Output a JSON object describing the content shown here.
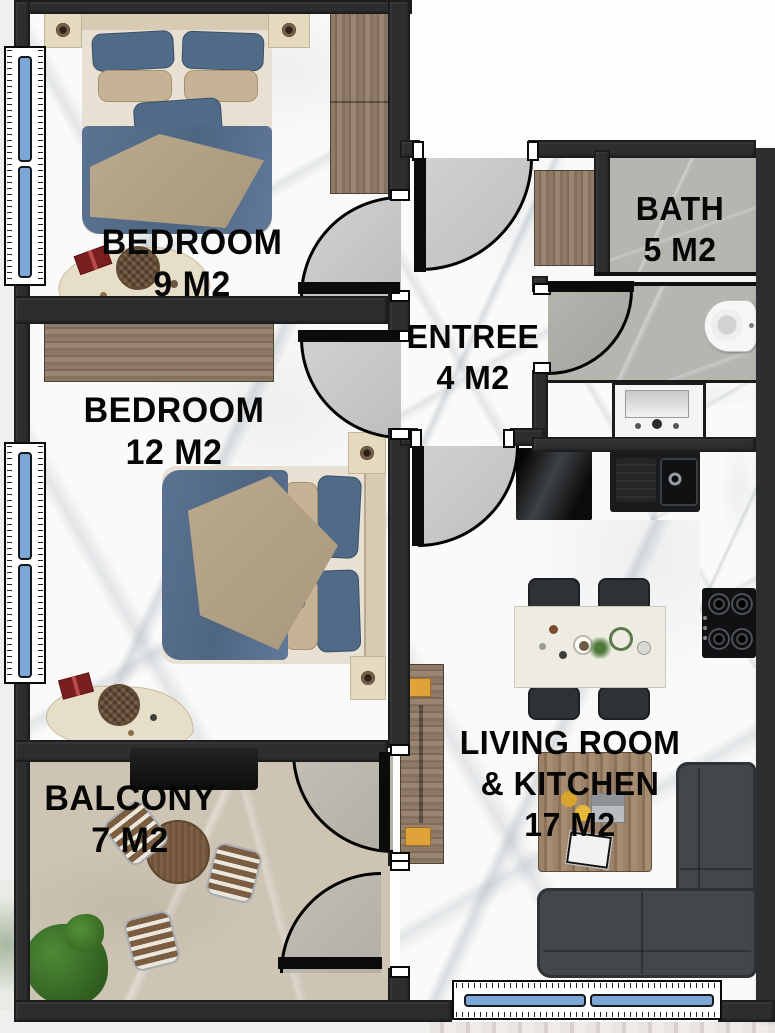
{
  "title": "Apartment floor plan",
  "rooms": {
    "bedroom9": {
      "name": "BEDROOM",
      "area": "9 M2"
    },
    "bedroom12": {
      "name": "BEDROOM",
      "area": "12 M2"
    },
    "entree": {
      "name": "ENTREE",
      "area": "4 M2"
    },
    "bath": {
      "name": "BATH",
      "area": "5 M2"
    },
    "living": {
      "line1": "LIVING ROOM",
      "line2": "&  KITCHEN",
      "area": "17 M2"
    },
    "balcony": {
      "name": "BALCONY",
      "area": "7 M2"
    }
  },
  "colors": {
    "wall": "#2d2e30",
    "floor_marble": "#fafafa",
    "floor_bath": "#b5b6b0",
    "floor_balcony": "#cdc4b4",
    "door_swing": "#c8cac8",
    "window_glass": "#7aa6d8",
    "wood_dark": "#8f7a67",
    "wood_light": "#e7dec8",
    "bed_blue": "#5a7390",
    "blanket_beige": "#b3a087",
    "sofa_gray": "#43474b",
    "counter_black": "#191b1d",
    "accent_yellow": "#e0a23a",
    "plant_green": "#3e7a2d",
    "label_text": "#060606"
  },
  "furniture_icons": {
    "bedroom9": [
      "double-bed",
      "nightstand",
      "nightstand",
      "wardrobe",
      "desk",
      "basket",
      "gift-box"
    ],
    "bedroom12": [
      "double-bed",
      "nightstand",
      "nightstand",
      "wardrobe",
      "desk",
      "basket",
      "gift-box"
    ],
    "entree": [
      "closet"
    ],
    "bath": [
      "toilet",
      "vanity-sink",
      "shower-screen"
    ],
    "kitchen": [
      "black-cabinet",
      "kitchen-sink",
      "countertop",
      "gas-hob"
    ],
    "living": [
      "dining-table",
      "dining-chair",
      "sofa",
      "coffee-table",
      "tv-console",
      "laptop",
      "magazine",
      "lemons"
    ],
    "balcony": [
      "ac-unit",
      "round-table",
      "garden-chair",
      "plant"
    ]
  }
}
